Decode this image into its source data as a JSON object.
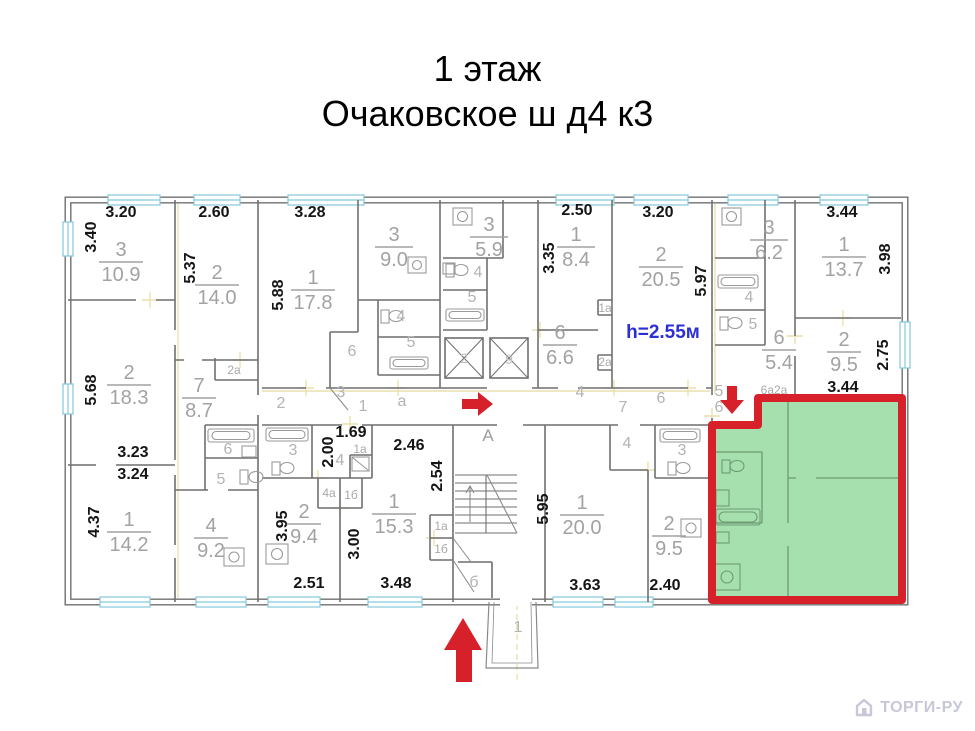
{
  "title": {
    "line1": "1 этаж",
    "line2": "Очаковское ш д4 к3"
  },
  "plan": {
    "note_height": "h=2.55м",
    "stairwell_letter": "А",
    "entrance_label": "1",
    "basement_label": "б",
    "rooms": [
      {
        "num": "3",
        "area": "10.9"
      },
      {
        "num": "2",
        "area": "14.0"
      },
      {
        "num": "1",
        "area": "17.8"
      },
      {
        "num": "3",
        "area": "9.0"
      },
      {
        "num": "3",
        "area": "5.9"
      },
      {
        "num": "1",
        "area": "8.4"
      },
      {
        "num": "2",
        "area": "20.5"
      },
      {
        "num": "3",
        "area": "6.2"
      },
      {
        "num": "1",
        "area": "13.7"
      },
      {
        "num": "6",
        "area": "6.6"
      },
      {
        "num": "6",
        "area": "5.4"
      },
      {
        "num": "2",
        "area": "9.5"
      },
      {
        "num": "2",
        "area": "18.3"
      },
      {
        "num": "7",
        "area": "8.7"
      },
      {
        "num": "1",
        "area": "14.2"
      },
      {
        "num": "4",
        "area": "9.2"
      },
      {
        "num": "2",
        "area": "9.4"
      },
      {
        "num": "1",
        "area": "15.3"
      },
      {
        "num": "1",
        "area": "20.0"
      },
      {
        "num": "2",
        "area": "9.5"
      }
    ],
    "dims": [
      "3.20",
      "2.60",
      "3.28",
      "2.50",
      "3.20",
      "3.44",
      "3.40",
      "5.37",
      "5.88",
      "5.68",
      "3.35",
      "5.97",
      "3.98",
      "2.75",
      "3.23",
      "3.24",
      "4.37",
      "1.69",
      "2.00",
      "2.46",
      "2.54",
      "3.95",
      "3.00",
      "2.51",
      "3.48",
      "5.95",
      "3.63",
      "2.40",
      "3.44"
    ],
    "corridor_labels": [
      "2",
      "3",
      "1",
      "а",
      "4",
      "7",
      "6"
    ],
    "small_labels": [
      "2а",
      "6",
      "5",
      "6",
      "4",
      "5",
      "4",
      "5",
      "4",
      "5",
      "1а",
      "2а",
      "3",
      "4",
      "1а",
      "4а",
      "1б",
      "1а",
      "1б",
      "4",
      "3",
      "5",
      "6",
      "6а2а",
      "2",
      "9"
    ],
    "colors": {
      "wall": "#6f6f6f",
      "dimension_text": "#151515",
      "room_text": "#a2a2a2",
      "window": "#85c9dd",
      "axis_lines": "#e9e0ae",
      "highlight_fill": "#a6e0ae",
      "highlight_border": "#d6212a",
      "arrow": "#d6212a",
      "height_note": "#2b2fd4"
    }
  },
  "watermark": {
    "text": "ТОРГИ-РУ"
  }
}
